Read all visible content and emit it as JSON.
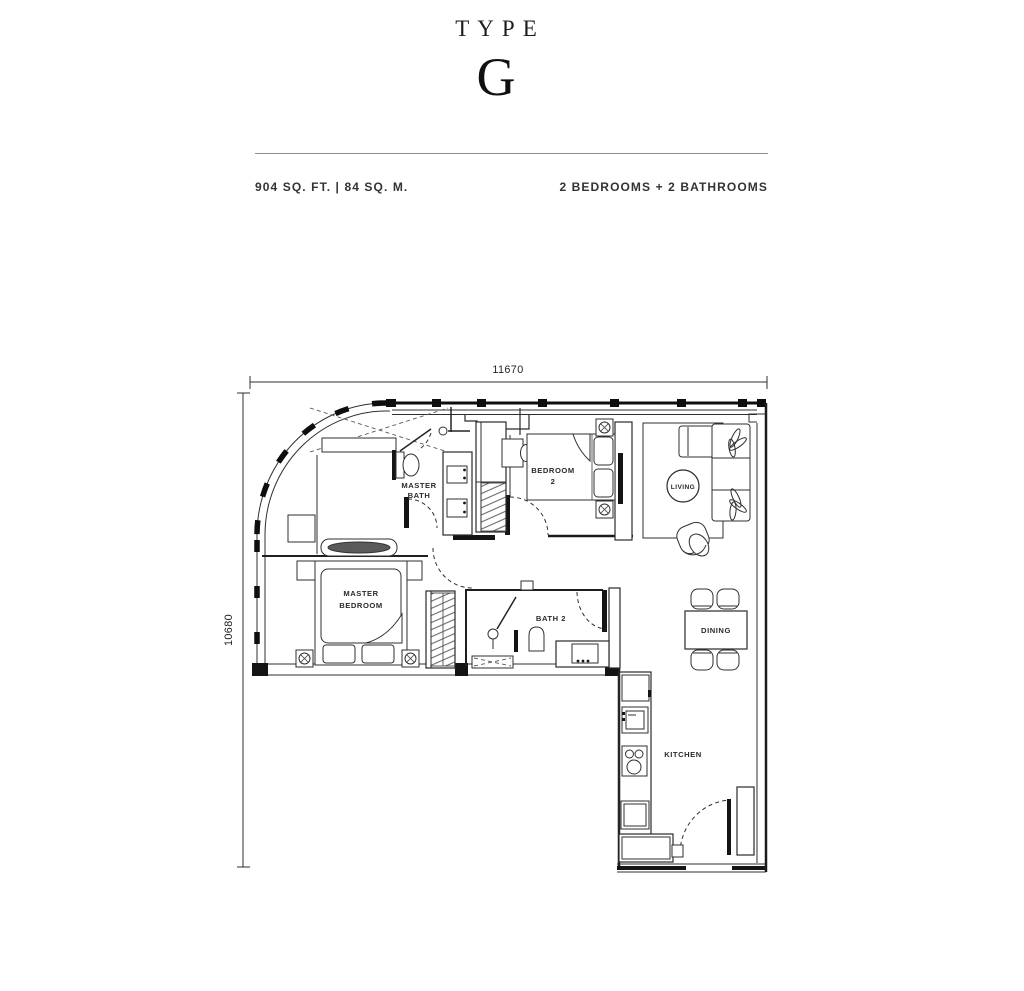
{
  "header": {
    "type_label": "TYPE",
    "type_letter": "G",
    "area_text": "904 SQ. FT.  |  84 SQ. M.",
    "rooms_text": "2 BEDROOMS + 2 BATHROOMS"
  },
  "dimensions": {
    "top": "11670",
    "left": "10680"
  },
  "rooms": {
    "master_bath": {
      "line1": "MASTER",
      "line2": "BATH"
    },
    "master_bedroom": {
      "line1": "MASTER",
      "line2": "BEDROOM"
    },
    "bedroom_2": {
      "line1": "BEDROOM",
      "line2": "2"
    },
    "bath_2": {
      "label": "BATH 2"
    },
    "living": {
      "label": "LIVING"
    },
    "dining": {
      "label": "DINING"
    },
    "kitchen": {
      "label": "KITCHEN"
    }
  },
  "colors": {
    "wall": "#141414",
    "furniture": "#2f2f2f",
    "text": "#2a2a2a",
    "divider": "#8f8f8f"
  }
}
